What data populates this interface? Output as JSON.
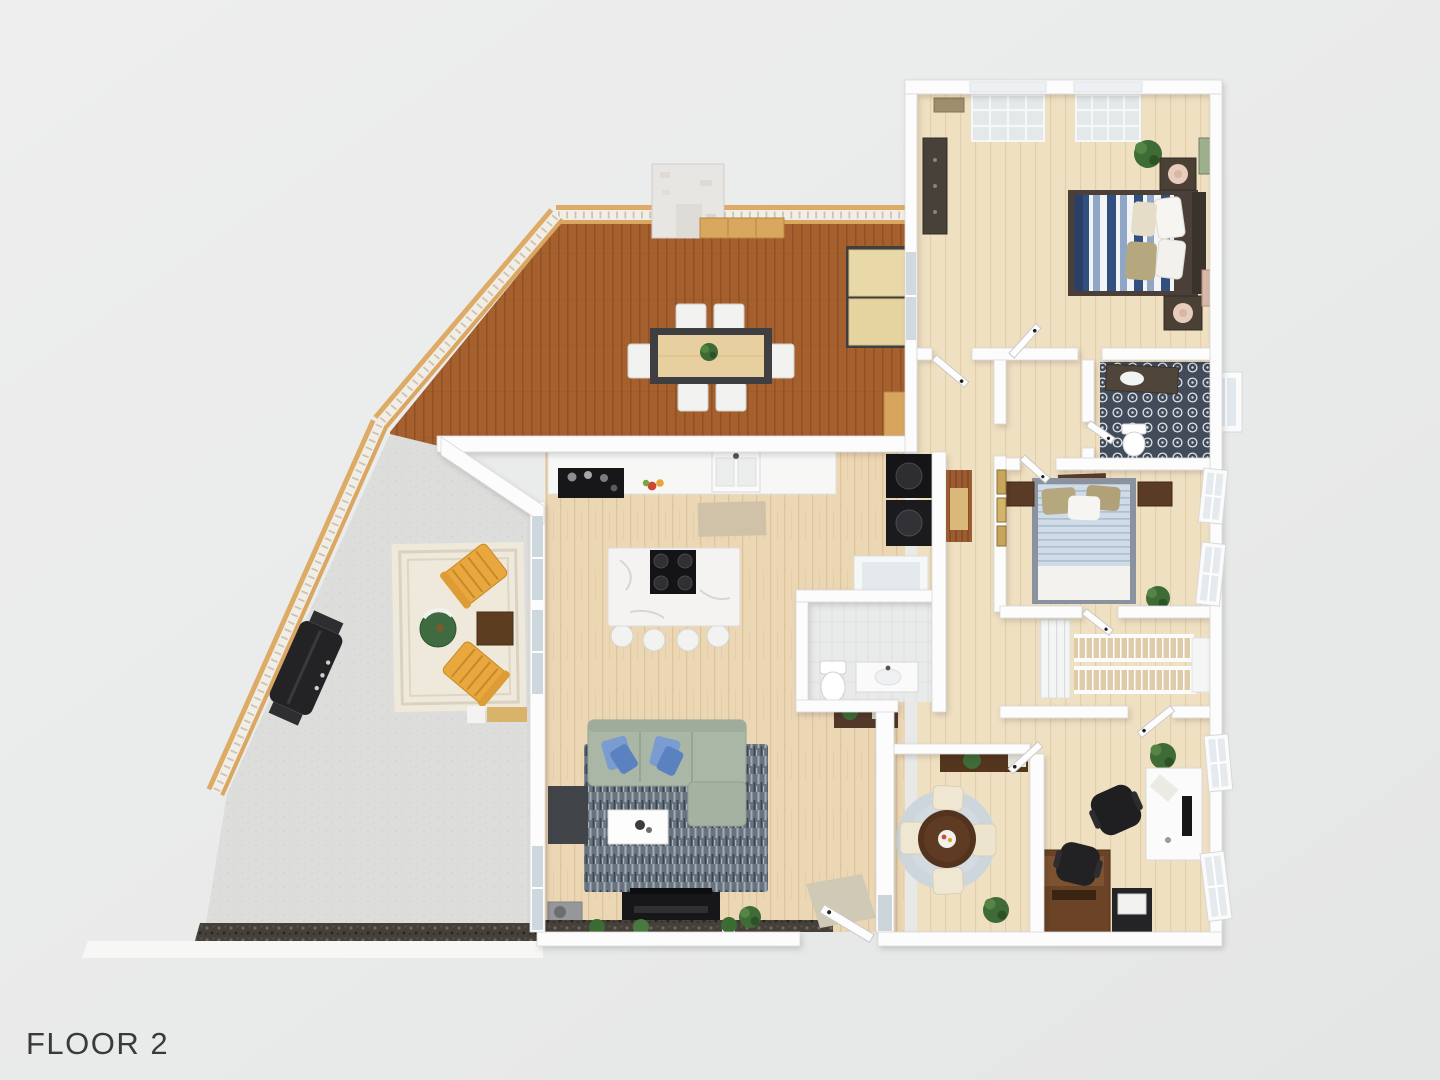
{
  "floor_label": "FLOOR 2",
  "palette": {
    "background": "#e9eaea",
    "deck_wood": "#a5602e",
    "railing_wood": "#ddab66",
    "railing_panel": "#f2eee6",
    "interior_floor": "#ecd7b5",
    "bedroom_floor": "#f0e0c2",
    "wall_white": "#fcfcfd",
    "patio_concrete": "#dddddb",
    "gravel_dark": "#45403a",
    "living_rug": "#67737f",
    "sofa_sage": "#aab7a7",
    "pillow_blue": "#6f94cf",
    "island_marble": "#f4f3f1",
    "cooktop_black": "#141416",
    "bath_tile": "#414b59",
    "bed1_stripe_navy": "#32507f",
    "bed2_stripe_blue": "#cfdbe6",
    "nightstand_brown": "#4a4036",
    "office_desk_wood": "#6b4326",
    "round_table_brown": "#53331e",
    "chair_cream": "#efe7d2",
    "adirondack_yellow": "#e9a83e",
    "side_table_green": "#3e6b40",
    "grill_black": "#232325",
    "stairs_wood": "#decbaa"
  },
  "areas": {
    "deck": {
      "name": "deck",
      "furniture": [
        "chimney",
        "railing",
        "bench",
        "dining-table",
        "dining-chairs-x6",
        "table-plant",
        "daybed",
        "storage-cabinet"
      ]
    },
    "patio": {
      "name": "patio",
      "furniture": [
        "area-rug",
        "adirondack-chair-x2",
        "green-side-table",
        "wood-side-table",
        "grill",
        "gravel-bed"
      ]
    },
    "kitchen": {
      "name": "kitchen",
      "furniture": [
        "wall-counter",
        "stove",
        "sink",
        "fruit-bowl",
        "island-with-cooktop",
        "stools-x4",
        "rug",
        "washer-dryer"
      ]
    },
    "living_room": {
      "name": "living-room",
      "furniture": [
        "sectional-sofa",
        "pillows",
        "rug",
        "coffee-table",
        "tv-console",
        "speaker",
        "hearth-plants",
        "side-chair",
        "entry-door",
        "doormat"
      ]
    },
    "hall_bath": {
      "name": "hall-bathroom",
      "furniture": [
        "toilet",
        "vanity",
        "shower",
        "console-table-plant"
      ]
    },
    "master_bedroom": {
      "name": "master-bedroom",
      "furniture": [
        "bed-striped-blue",
        "nightstand-x2",
        "lamps",
        "dresser",
        "plant",
        "wall-art",
        "windows-x2"
      ]
    },
    "bathroom2": {
      "name": "tiled-bathroom",
      "furniture": [
        "patterned-tile-floor",
        "toilet",
        "dark-vanity",
        "shower-bay"
      ]
    },
    "bedroom2": {
      "name": "second-bedroom",
      "furniture": [
        "bed-light-blue",
        "nightstand-x2",
        "mirror-art",
        "windows"
      ]
    },
    "stair_hall": {
      "name": "stair-hall",
      "furniture": [
        "staircase-double-run",
        "railings",
        "linen-closet",
        "plants"
      ]
    },
    "office": {
      "name": "office",
      "furniture": [
        "wood-desk",
        "white-desk",
        "office-chair-x2",
        "printer-cart",
        "plant",
        "windows"
      ]
    },
    "breakfast_nook": {
      "name": "breakfast-nook",
      "furniture": [
        "round-table",
        "cream-chairs-x4",
        "round-rug",
        "sideboard",
        "plants"
      ]
    }
  }
}
